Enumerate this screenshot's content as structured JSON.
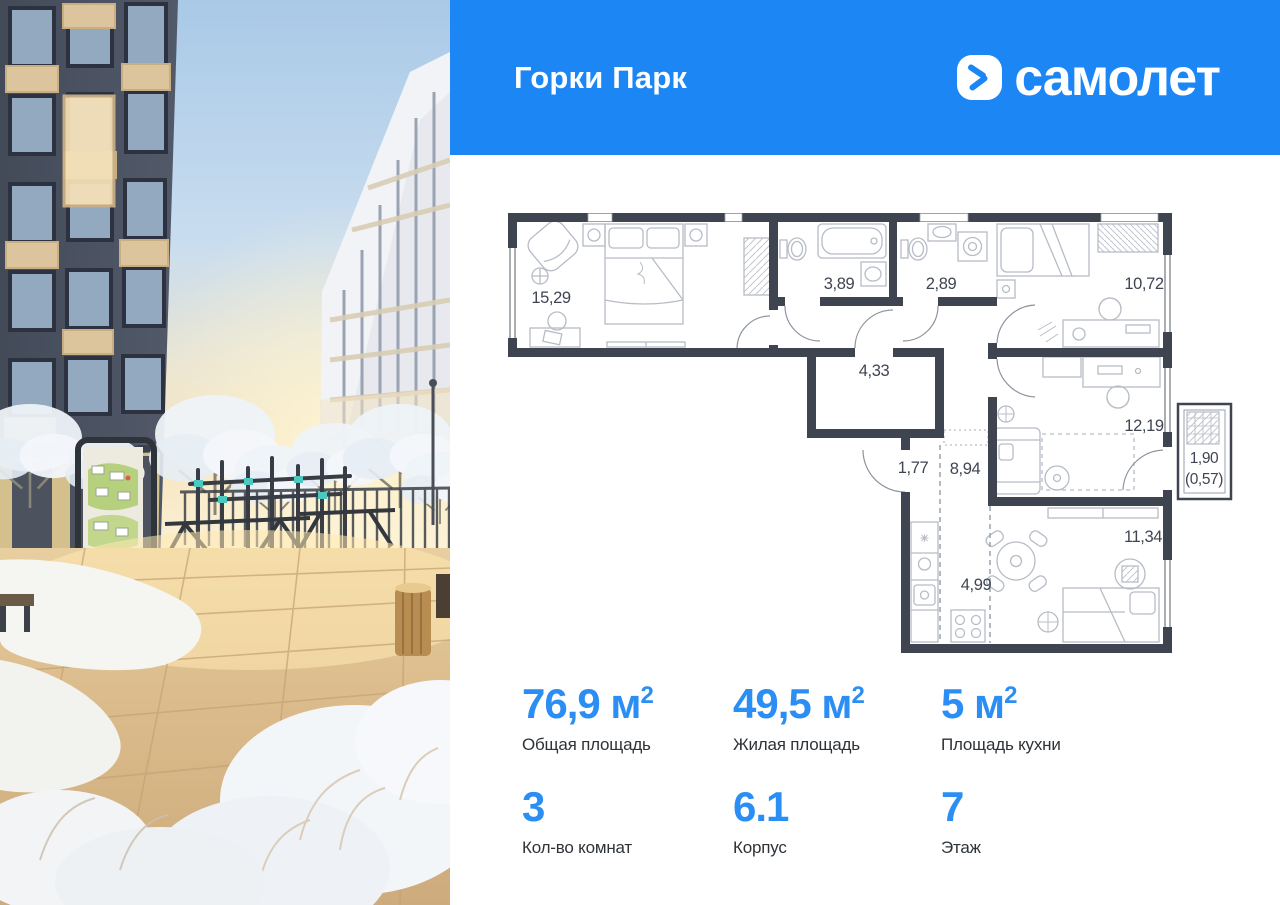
{
  "header": {
    "project_title": "Горки Парк",
    "brand_name": "самолет"
  },
  "colors": {
    "header_blue": "#1b86f4",
    "stat_blue": "#2b8ef5",
    "wall": "#3e4450",
    "furniture": "#b7bcc5",
    "door_arc": "#8d949e"
  },
  "floorplan": {
    "rooms": [
      {
        "name": "bedroom-main",
        "area_label": "15,29",
        "x": 551,
        "y": 303
      },
      {
        "name": "bathroom",
        "area_label": "3,89",
        "x": 839,
        "y": 289
      },
      {
        "name": "toilet",
        "area_label": "2,89",
        "x": 941,
        "y": 289
      },
      {
        "name": "bedroom-2",
        "area_label": "10,72",
        "x": 1144,
        "y": 289
      },
      {
        "name": "wardrobe-room",
        "area_label": "4,33",
        "x": 874,
        "y": 376
      },
      {
        "name": "hall",
        "area_label": "1,77",
        "x": 913,
        "y": 473
      },
      {
        "name": "corridor",
        "area_label": "8,94",
        "x": 965,
        "y": 474
      },
      {
        "name": "room-3",
        "area_label": "12,19",
        "x": 1144,
        "y": 431
      },
      {
        "name": "balcony",
        "area_label": "1,90",
        "x": 1204,
        "y": 463,
        "small": true
      },
      {
        "name": "balcony-coeff",
        "area_label": "(0,57)",
        "x": 1204,
        "y": 484,
        "small": true
      },
      {
        "name": "kitchen",
        "area_label": "4,99",
        "x": 976,
        "y": 590
      },
      {
        "name": "living",
        "area_label": "11,34",
        "x": 1143,
        "y": 542
      }
    ]
  },
  "stats": {
    "items": [
      {
        "value": "76,9",
        "unit": "м",
        "unit_sup": "2",
        "label": "Общая площадь"
      },
      {
        "value": "49,5",
        "unit": "м",
        "unit_sup": "2",
        "label": "Жилая площадь"
      },
      {
        "value": "5",
        "unit": "м",
        "unit_sup": "2",
        "label": "Площадь кухни"
      },
      {
        "value": "3",
        "unit": "",
        "unit_sup": "",
        "label": "Кол-во комнат"
      },
      {
        "value": "6.1",
        "unit": "",
        "unit_sup": "",
        "label": "Корпус"
      },
      {
        "value": "7",
        "unit": "",
        "unit_sup": "",
        "label": "Этаж"
      }
    ]
  }
}
